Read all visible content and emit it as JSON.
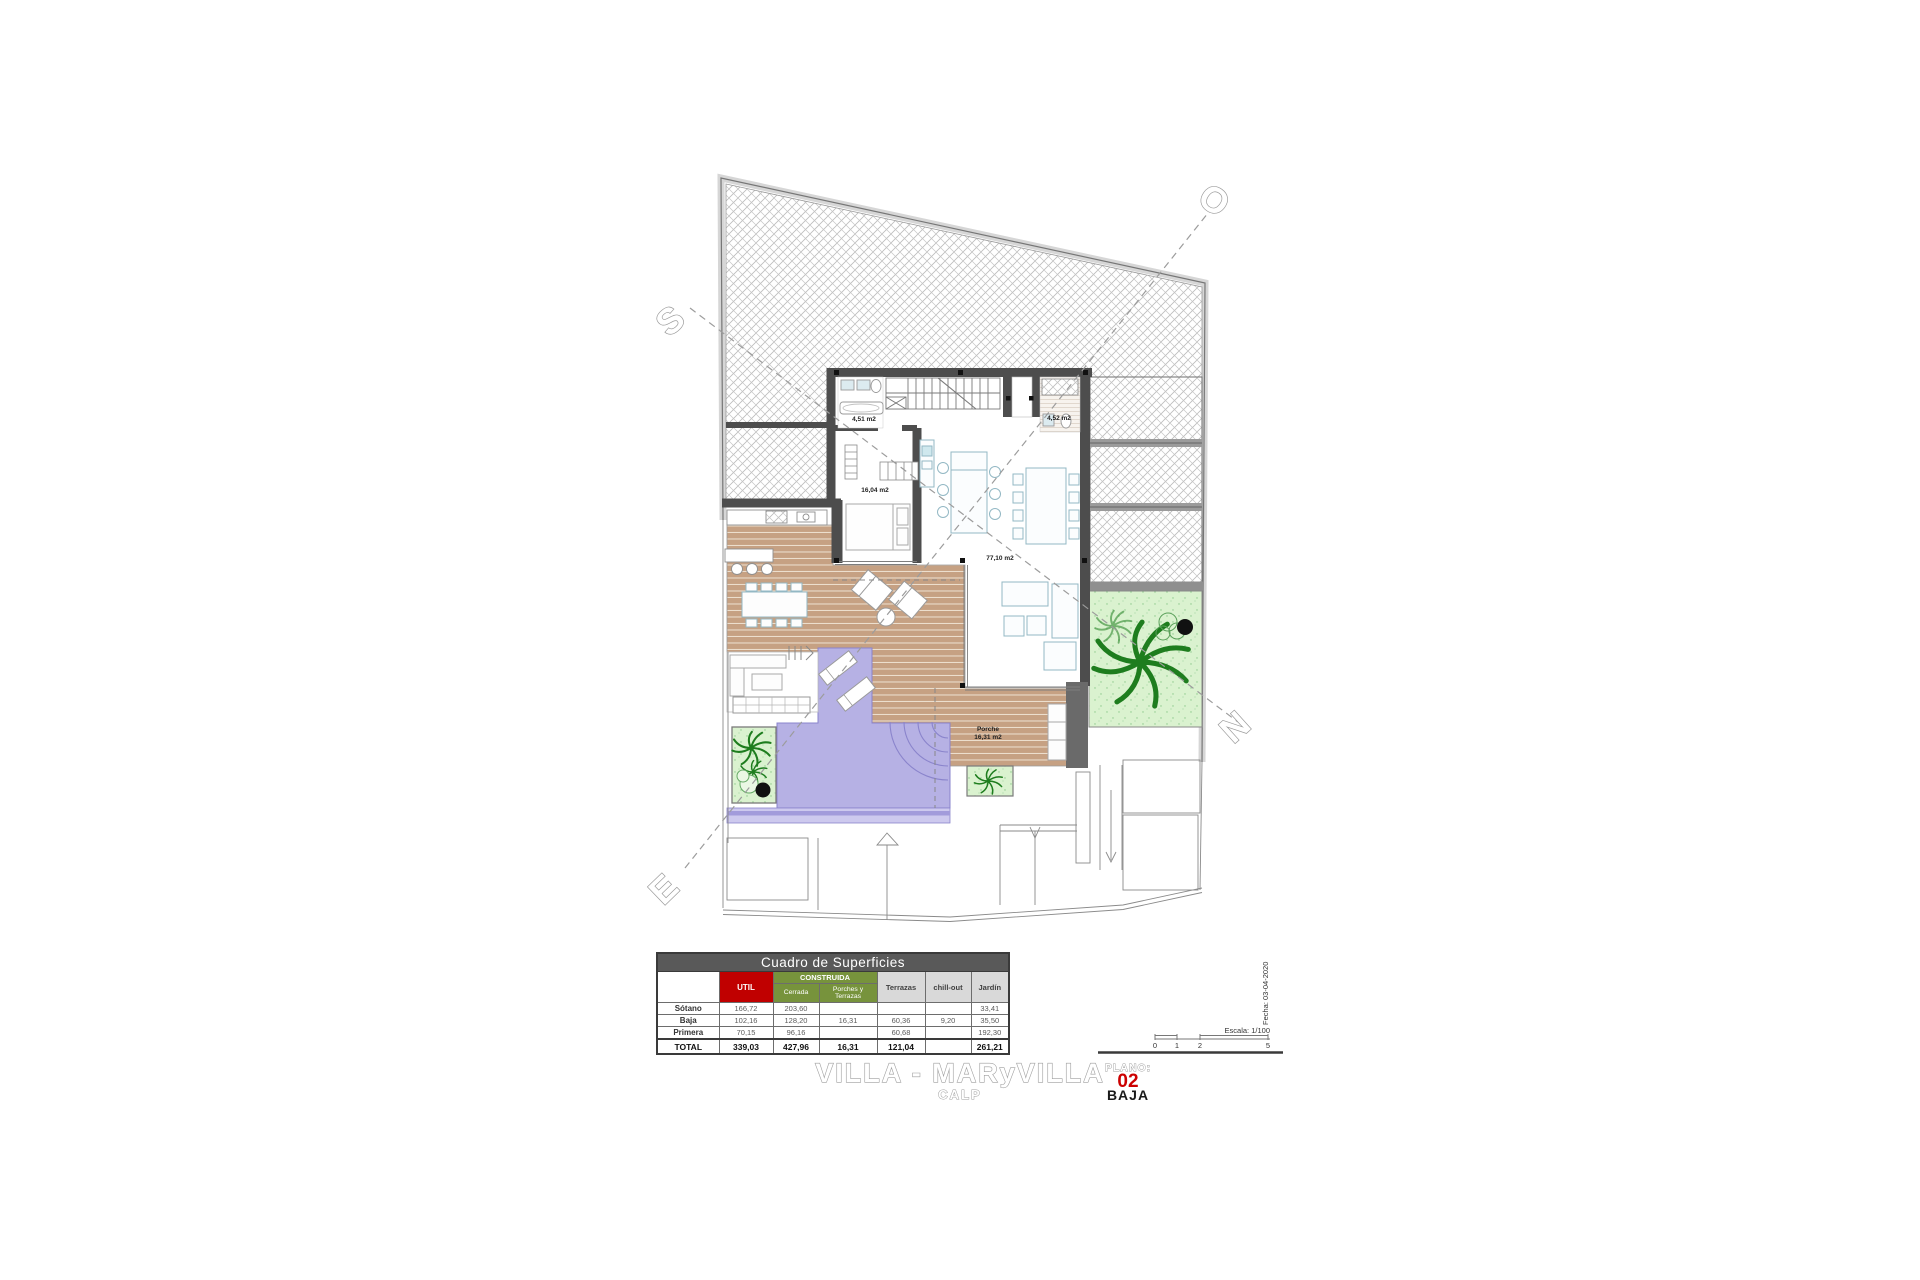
{
  "plan": {
    "area_labels": {
      "bath_left": "4,51 m2",
      "bath_right": "4,52 m2",
      "bedroom": "16,04 m2",
      "living": "77,10 m2",
      "porche_name": "Porche",
      "porche_area": "16,31 m2"
    },
    "compass": {
      "south": "S",
      "west": "O",
      "north": "N",
      "east": "E"
    }
  },
  "surface_table": {
    "title": "Cuadro de Superficies",
    "col_headers": {
      "util": "UTIL",
      "construida": "CONSTRUIDA",
      "cerrada": "Cerrada",
      "porches": "Porches y Terrazas",
      "terrazas": "Terrazas",
      "chill_out": "chill-out",
      "jardin": "Jardín"
    },
    "rows": [
      {
        "label": "Sótano",
        "util": "166,72",
        "cerrada": "203,60",
        "porches": "",
        "terrazas": "",
        "chill_out": "",
        "jardin": "33,41"
      },
      {
        "label": "Baja",
        "util": "102,16",
        "cerrada": "128,20",
        "porches": "16,31",
        "terrazas": "60,36",
        "chill_out": "9,20",
        "jardin": "35,50"
      },
      {
        "label": "Primera",
        "util": "70,15",
        "cerrada": "96,16",
        "porches": "",
        "terrazas": "60,68",
        "chill_out": "",
        "jardin": "192,30"
      },
      {
        "label": "TOTAL",
        "util": "339,03",
        "cerrada": "427,96",
        "porches": "16,31",
        "terrazas": "121,04",
        "chill_out": "",
        "jardin": "261,21"
      }
    ]
  },
  "title_block": {
    "project": "VILLA - MARyVILLA",
    "location": "CALP",
    "plano_label": "PLANO:",
    "plano_number": "02",
    "plano_name": "BAJA",
    "fecha": "Fecha: 03-04-2020",
    "escala": "Escala: 1/100",
    "scale_ticks": [
      "0",
      "1",
      "2",
      "5"
    ]
  },
  "colors": {
    "wall": "#4d4d4d",
    "boundary_band": "#d6d6d6",
    "deck": "#c6a183",
    "pool": "#b6b1e4",
    "garden": "#daf2cf",
    "plant": "#1e7d1e",
    "accent_red": "#cc0000",
    "table_green": "#77933c",
    "table_red": "#c00000"
  }
}
